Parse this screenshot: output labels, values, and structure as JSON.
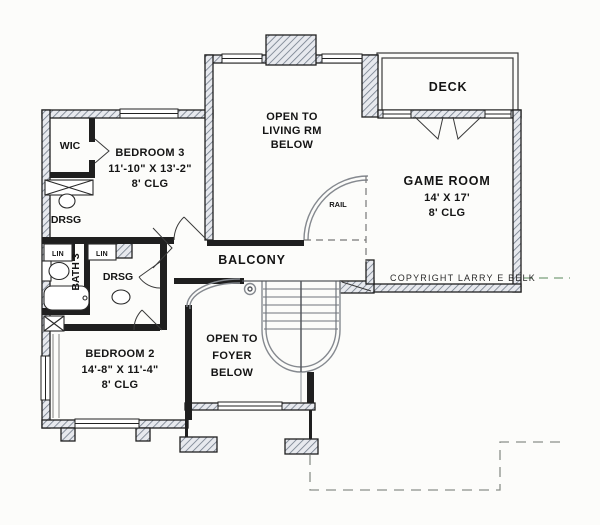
{
  "drawing_type": "second-floor house plan",
  "rooms": {
    "wic": {
      "name": "WIC"
    },
    "bedroom3": {
      "name": "BEDROOM 3",
      "dims": "11'-10\" X 13'-2\"",
      "clg": "8' CLG"
    },
    "open_living": {
      "line1": "OPEN TO",
      "line2": "LIVING RM",
      "line3": "BELOW"
    },
    "deck": {
      "name": "DECK"
    },
    "game_room": {
      "name": "GAME ROOM",
      "dims": "14' X 17'",
      "clg": "8' CLG"
    },
    "balcony": {
      "name": "BALCONY"
    },
    "rail": {
      "name": "RAIL"
    },
    "bath3": {
      "name": "BATH 3"
    },
    "drsg_upper": {
      "name": "DRSG"
    },
    "drsg_lower": {
      "name": "DRSG"
    },
    "lin_left": {
      "name": "LIN"
    },
    "lin_right": {
      "name": "LIN"
    },
    "bedroom2": {
      "name": "BEDROOM 2",
      "dims": "14'-8\" X 11'-4\"",
      "clg": "8' CLG"
    },
    "open_foyer": {
      "line1": "OPEN TO",
      "line2": "FOYER",
      "line3": "BELOW"
    }
  },
  "copyright": "COPYRIGHT LARRY E BELK",
  "colors": {
    "wall": "#1f1f1f",
    "hatch_line": "#707a88",
    "hatch_bg": "#e7e9ee",
    "stair_gray": "#85898f",
    "roof_dash": "#8a8f8a",
    "copyright_dash": "#8fae8f"
  }
}
